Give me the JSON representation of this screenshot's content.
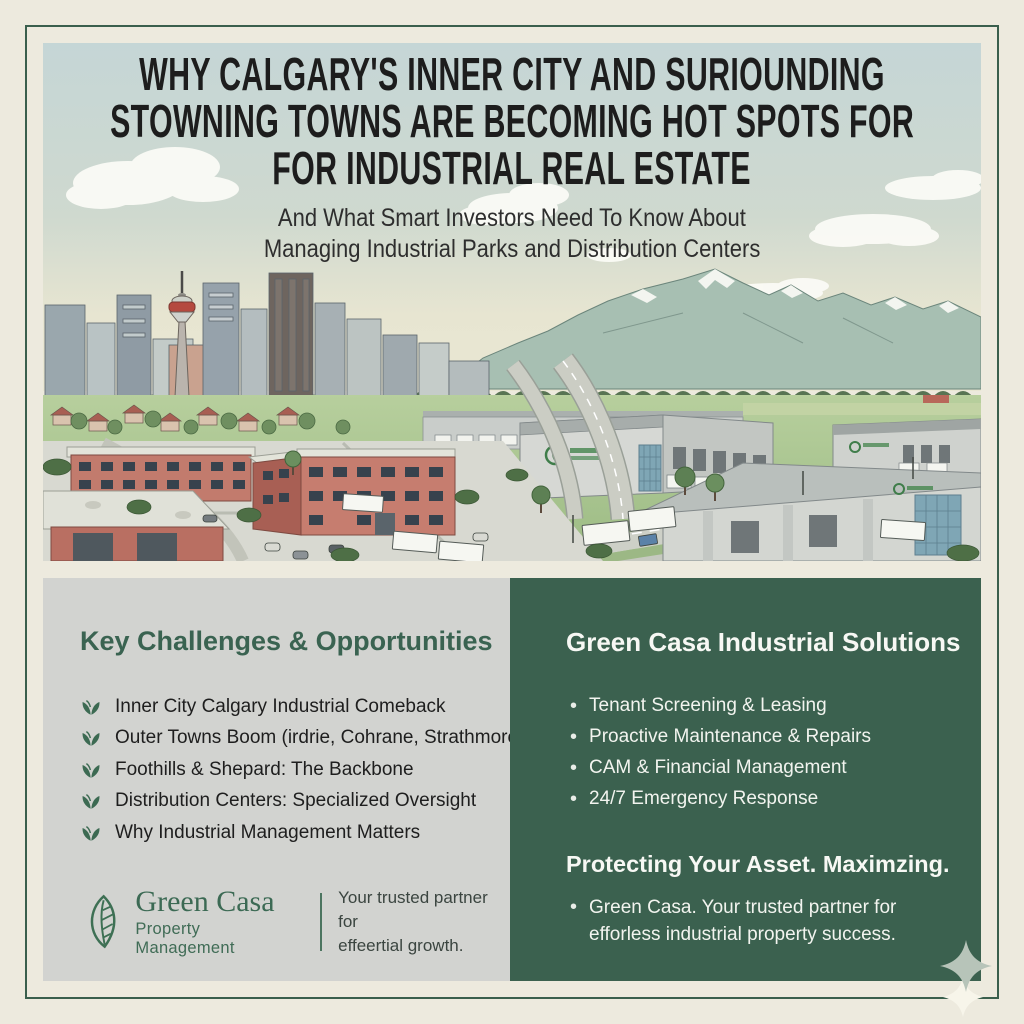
{
  "header": {
    "title_lines": [
      "WHY CALGARY'S INNER CITY AND SURIOUNDING",
      "STOWNING TOWNS ARE BECOMING HOT SPOTS FOR",
      "FOR INDUSTRIAL REAL ESTATE"
    ],
    "subtitle_lines": [
      "And What Smart Investors Need To Know About",
      "Managing Industrial Parks and Distribution Centers"
    ]
  },
  "illustration": {
    "alt": "Aerial illustration of Calgary inner city skyline with Calgary Tower, Rocky Mountains, red brick industrial buildings, highways with trucks, and large distribution warehouses"
  },
  "challenges": {
    "heading": "Key Challenges & Opportunities",
    "items": [
      "Inner City Calgary Industrial Comeback",
      "Outer Towns Boom (irdrie, Cohrane, Strathmore)",
      "Foothills & Shepard: The Backbone",
      "Distribution Centers: Specialized Oversight",
      "Why Industrial Management Matters"
    ]
  },
  "solutions": {
    "heading": "Green Casa Industrial Solutions",
    "items": [
      "Tenant Screening & Leasing",
      "Proactive Maintenance & Repairs",
      "CAM & Financial Management",
      "24/7 Emergency Response"
    ],
    "subheading": "Protecting Your Asset. Maximzing.",
    "footer_line1": "Green  Casa. Your trusted partner for",
    "footer_line2": "efforless industrial property success."
  },
  "brand": {
    "name": "Green Casa",
    "descriptor": "Property Management",
    "tagline_line1": "Your trusted partner for",
    "tagline_line2": "effeertial growth."
  },
  "colors": {
    "background": "#edeade",
    "frame_green": "#3a5f4d",
    "panel_gray": "#d2d3d0",
    "panel_green": "#3b614f",
    "heading_green": "#3a6351",
    "brick_red": "#c27b6d",
    "mountain_sage": "#a7bfb2"
  }
}
